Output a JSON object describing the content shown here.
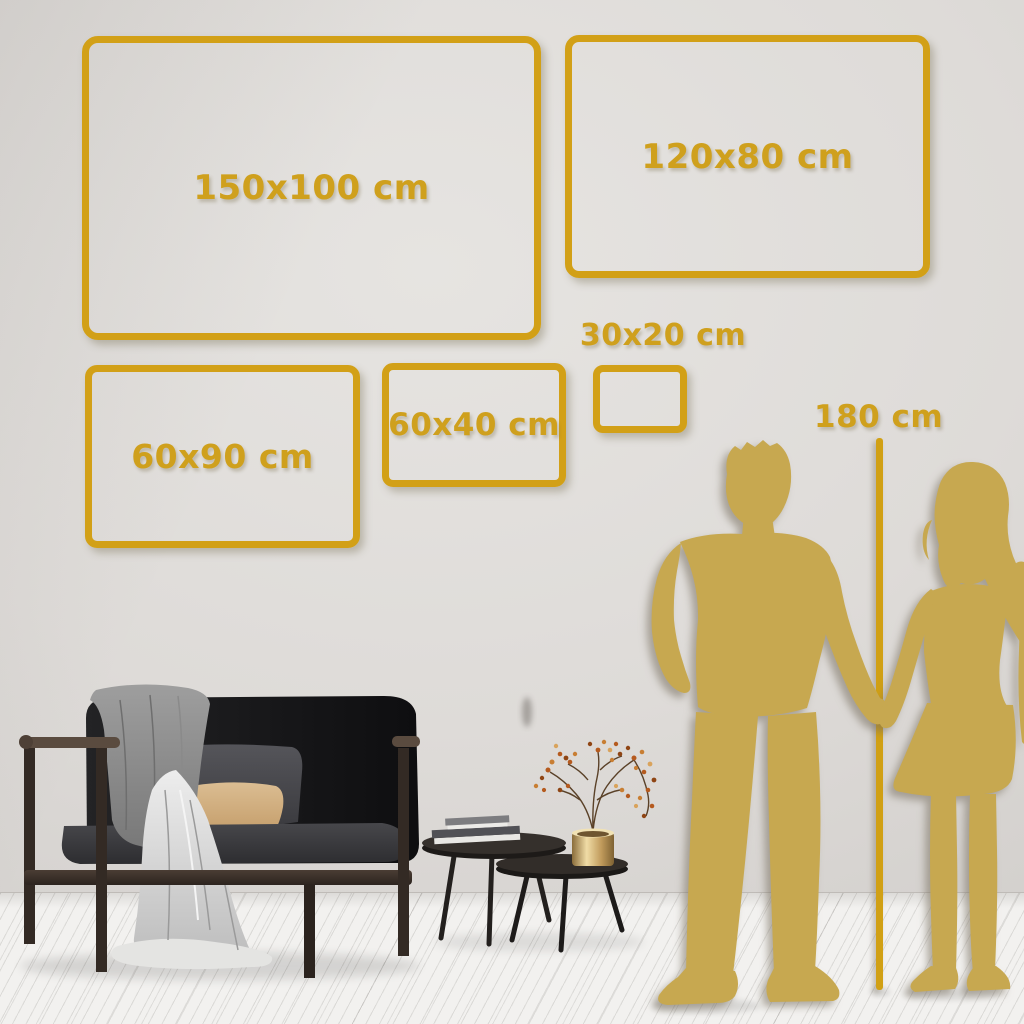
{
  "size_guide": {
    "boxes": [
      {
        "id": "box-150x100",
        "label": "150x100 cm"
      },
      {
        "id": "box-120x80",
        "label": "120x80 cm"
      },
      {
        "id": "box-60x90",
        "label": "60x90 cm"
      },
      {
        "id": "box-60x40",
        "label": "60x40 cm"
      },
      {
        "id": "box-30x20",
        "label": "30x20 cm"
      }
    ],
    "height_reference_label": "180 cm"
  },
  "colors": {
    "frame_gold": "#D2A017",
    "label_gold": "#CFA01D",
    "silhouette_gold": "#C7A850",
    "wall": "#DBD8D5",
    "floor": "#F2F1EF"
  },
  "figures": {
    "couple": "couple-silhouette",
    "sofa": "dark-sofa-with-blanket",
    "tables": "nesting-coffee-tables",
    "plant": "dried-branch-in-brass-vase",
    "measuring_line": "vertical-height-line"
  }
}
